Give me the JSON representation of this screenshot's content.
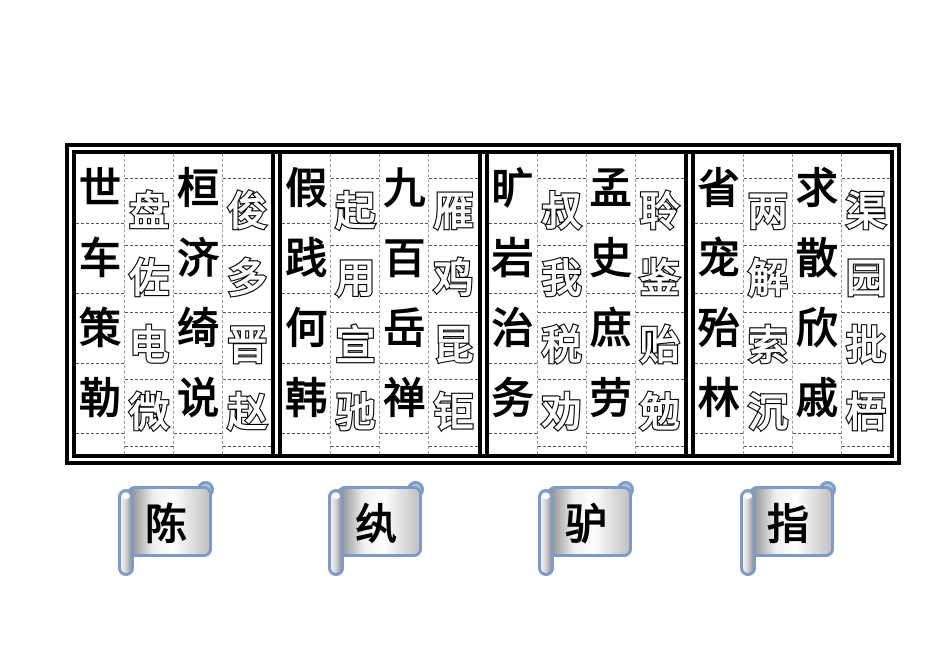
{
  "board": {
    "panels": [
      {
        "columns": [
          {
            "style": "solid",
            "chars": [
              "世",
              "车",
              "策",
              "勒"
            ]
          },
          {
            "style": "outline",
            "chars": [
              "盘",
              "佐",
              "电",
              "微"
            ]
          },
          {
            "style": "solid",
            "chars": [
              "桓",
              "济",
              "绮",
              "说"
            ]
          },
          {
            "style": "outline",
            "chars": [
              "俊",
              "多",
              "晋",
              "赵"
            ]
          }
        ]
      },
      {
        "columns": [
          {
            "style": "solid",
            "chars": [
              "假",
              "践",
              "何",
              "韩"
            ]
          },
          {
            "style": "outline",
            "chars": [
              "起",
              "用",
              "宣",
              "驰"
            ]
          },
          {
            "style": "solid",
            "chars": [
              "九",
              "百",
              "岳",
              "禅"
            ]
          },
          {
            "style": "outline",
            "chars": [
              "雁",
              "鸡",
              "昆",
              "钜"
            ]
          }
        ]
      },
      {
        "columns": [
          {
            "style": "solid",
            "chars": [
              "旷",
              "岩",
              "治",
              "务"
            ]
          },
          {
            "style": "outline",
            "chars": [
              "叔",
              "我",
              "税",
              "劝"
            ]
          },
          {
            "style": "solid",
            "chars": [
              "孟",
              "史",
              "庶",
              "劳"
            ]
          },
          {
            "style": "outline",
            "chars": [
              "聆",
              "鉴",
              "贻",
              "勉"
            ]
          }
        ]
      },
      {
        "columns": [
          {
            "style": "solid",
            "chars": [
              "省",
              "宠",
              "殆",
              "林"
            ]
          },
          {
            "style": "outline",
            "chars": [
              "两",
              "解",
              "索",
              "沉"
            ]
          },
          {
            "style": "solid",
            "chars": [
              "求",
              "散",
              "欣",
              "戚"
            ]
          },
          {
            "style": "outline",
            "chars": [
              "渠",
              "园",
              "批",
              "梧"
            ]
          }
        ]
      }
    ]
  },
  "scrolls": [
    {
      "label": "陈"
    },
    {
      "label": "纨"
    },
    {
      "label": "驴"
    },
    {
      "label": "指"
    }
  ],
  "colors": {
    "board_border": "#000000",
    "tile_solid": "#000000",
    "tile_outline_fill": "#ffffff",
    "tile_outline_stroke": "#000000",
    "grid_dash_line": "#555555",
    "column_dash_line": "#9a9a9a",
    "scroll_border": "#7d9bc4",
    "scroll_curl_fill": "#b4c3d9"
  }
}
